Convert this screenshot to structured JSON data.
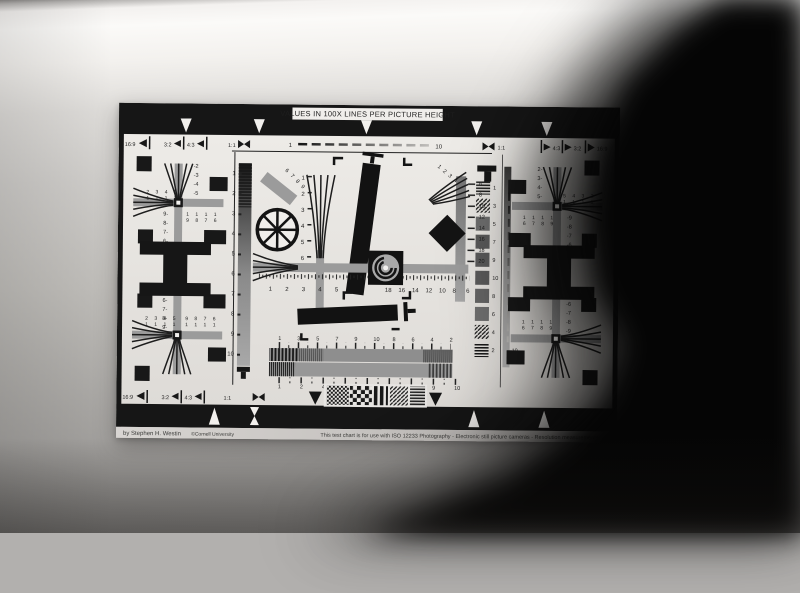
{
  "colors": {
    "chart_ink": "#181818",
    "chart_paper": "#e7e5e2",
    "chart_gray": "#9b9b9b",
    "wall_light": "#fbfaf8",
    "wall_dark": "#949290",
    "object_black": "#050505"
  },
  "chart": {
    "title": "VALUES IN 100X LINES PER PICTURE HEIGHT",
    "top_ruler": {
      "start": "1",
      "end": "10"
    },
    "side_ruler": {
      "start": "1",
      "end": "10"
    },
    "aspect_top_left": [
      "16:9",
      "3:2",
      "4:3",
      "1:1"
    ],
    "aspect_top_right": [
      "1:1",
      "4:3",
      "3:2",
      "16:9"
    ],
    "aspect_bottom_left": [
      "16:9",
      "3:2",
      "4:3",
      "1:1"
    ],
    "left_scale": [
      "1",
      "2",
      "3",
      "4",
      "5",
      "6",
      "7",
      "8",
      "9",
      "10"
    ],
    "right_scale": [
      "1",
      "3",
      "5",
      "7",
      "9",
      "10",
      "8",
      "6",
      "4",
      "2"
    ],
    "center": {
      "wedge_left": [
        "1",
        "2",
        "3",
        "4",
        "5",
        "6"
      ],
      "bar_scale": [
        "6",
        "8",
        "10",
        "12",
        "14",
        "16",
        "18",
        "20"
      ],
      "diag_left": [
        "6",
        "7",
        "8",
        "9"
      ],
      "diag_right": [
        "1",
        "2",
        "3",
        "4"
      ],
      "h_left": [
        "1",
        "2",
        "3",
        "4",
        "5"
      ],
      "h_right": [
        "18",
        "16",
        "14",
        "12",
        "10",
        "8",
        "6"
      ],
      "bottom_upper": [
        "1",
        "3",
        "5",
        "7",
        "9",
        "10",
        "8",
        "6",
        "4",
        "2"
      ],
      "bottom_lower": [
        "1",
        "2",
        "4",
        "5",
        "6",
        "7",
        "8",
        "9",
        "10"
      ]
    },
    "cross_ul": {
      "fan_v": [
        "-2",
        "-3",
        "-4",
        "-5"
      ],
      "v_bottom": [
        "9-",
        "8-",
        "7-",
        "6-"
      ],
      "left_top": "2 3 4 5",
      "left_bot": "1 1 1 1",
      "right_top": "1 1 1 1",
      "right_bot": "9 8 7 6"
    },
    "cross_ll": {
      "v_top": [
        "6-",
        "7-",
        "8-",
        "9-"
      ],
      "left_top": "2 3 4 5",
      "left_bot": "1 1 1 1",
      "right_top": "9 8 7 6",
      "right_bot": "1 1 1 1"
    },
    "cross_ur": {
      "fan_v": [
        "2-",
        "3-",
        "4-",
        "5-"
      ],
      "v_bottom": [
        "-9",
        "-8",
        "-7",
        "-6"
      ],
      "right_top": "5 4 3 2",
      "right_bot": "1 1 1 1",
      "left_top": "1 1 1 1",
      "left_bot": "6 7 8 9"
    },
    "cross_lr": {
      "v_top": [
        "-6",
        "-7",
        "-8",
        "-9"
      ],
      "left_top": "1 1 1 1",
      "left_bot": "6 7 8 9"
    },
    "footer": {
      "credit": "by Stephen H. Westin",
      "org": "©Cornell University",
      "usage": "This test chart is for use with ISO 12233 Photography - Electronic still picture cameras - Resolution measurements"
    }
  }
}
